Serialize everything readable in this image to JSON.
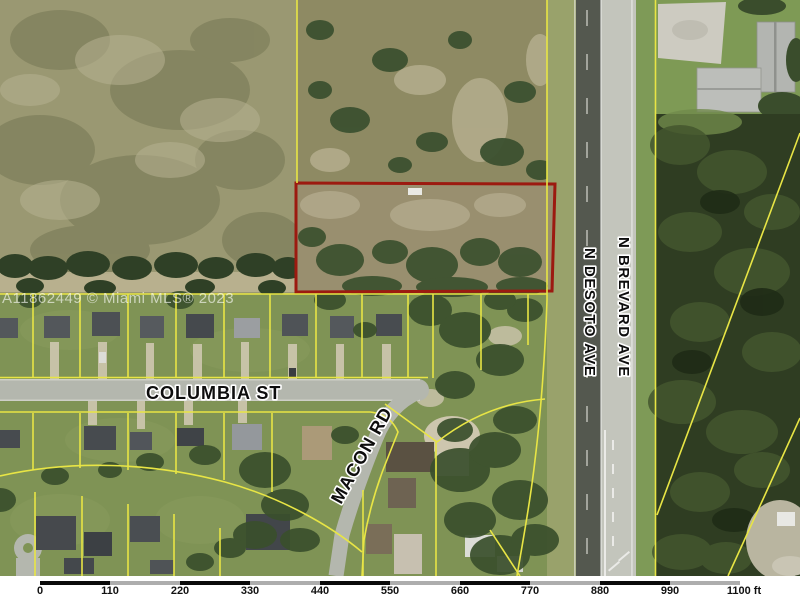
{
  "map": {
    "watermark": "A11862449 © Miami MLS® 2023",
    "street_labels": {
      "columbia": "COLUMBIA ST",
      "macon": "MACON RD",
      "desoto": "N DESOTO AVE",
      "brevard": "N BREVARD AVE"
    },
    "colors": {
      "parcel_line_yellow": "#e8e545",
      "subject_parcel_red": "#9c1a10",
      "scalebar_dark": "#0a0a0a",
      "scalebar_light": "#adadad"
    },
    "scale_bar": {
      "tick_labels": [
        "0",
        "110",
        "220",
        "330",
        "440",
        "550",
        "660",
        "770",
        "880",
        "990",
        "1100 ft"
      ]
    }
  }
}
